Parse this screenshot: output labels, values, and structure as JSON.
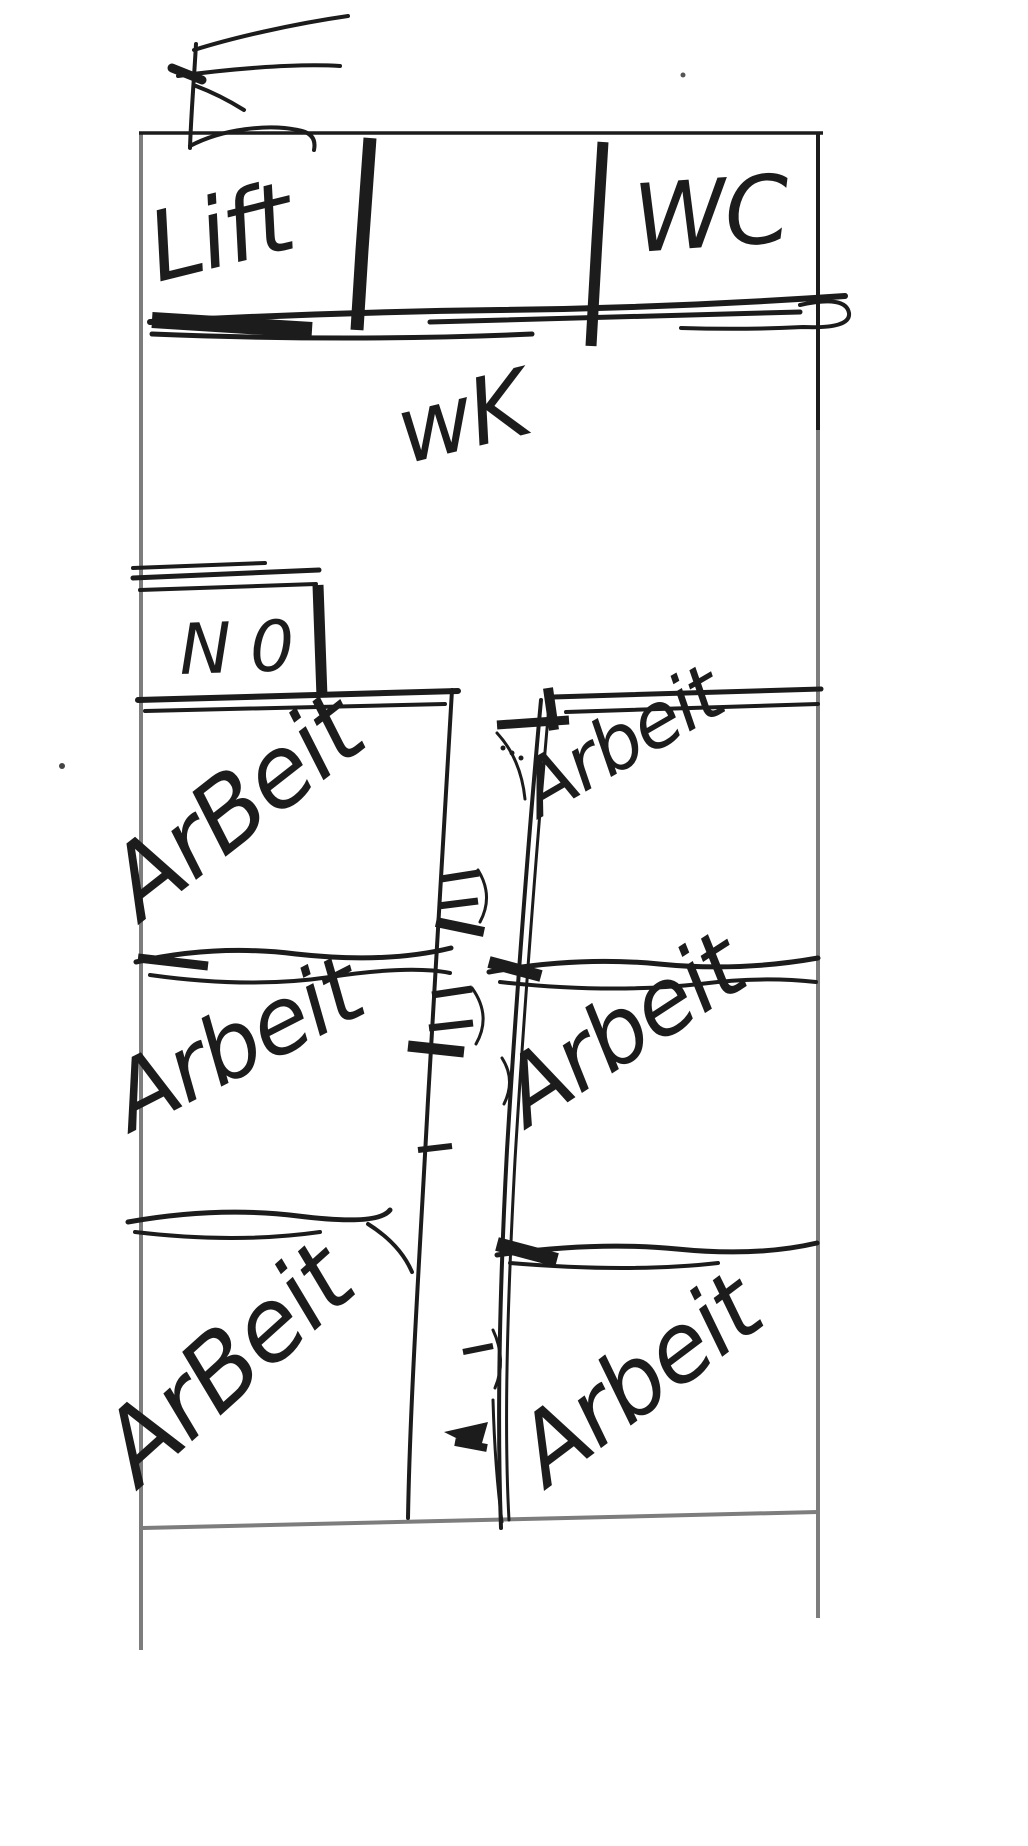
{
  "sketch": {
    "type": "hand-drawn floor plan",
    "background": "#ffffff",
    "ink_color": "#1c1c1c",
    "boundary_color": "#7d7d7d",
    "marks": {
      "top_left_mark": "e-shaped-scribble",
      "stray_dots": [
        "top-right-dot",
        "left-middle-dot"
      ]
    },
    "rooms": {
      "top_row": [
        {
          "label": "Lift"
        },
        {
          "label": "wK"
        },
        {
          "label": "WC"
        }
      ],
      "small_room": {
        "label": "N 0"
      },
      "left_column": [
        {
          "label": "ArBeit"
        },
        {
          "label": "Arbeit"
        },
        {
          "label": "ArBeit"
        }
      ],
      "right_column": [
        {
          "label": "Arbeit"
        },
        {
          "label": "Arbeit"
        },
        {
          "label": "Arbeit"
        }
      ]
    }
  }
}
